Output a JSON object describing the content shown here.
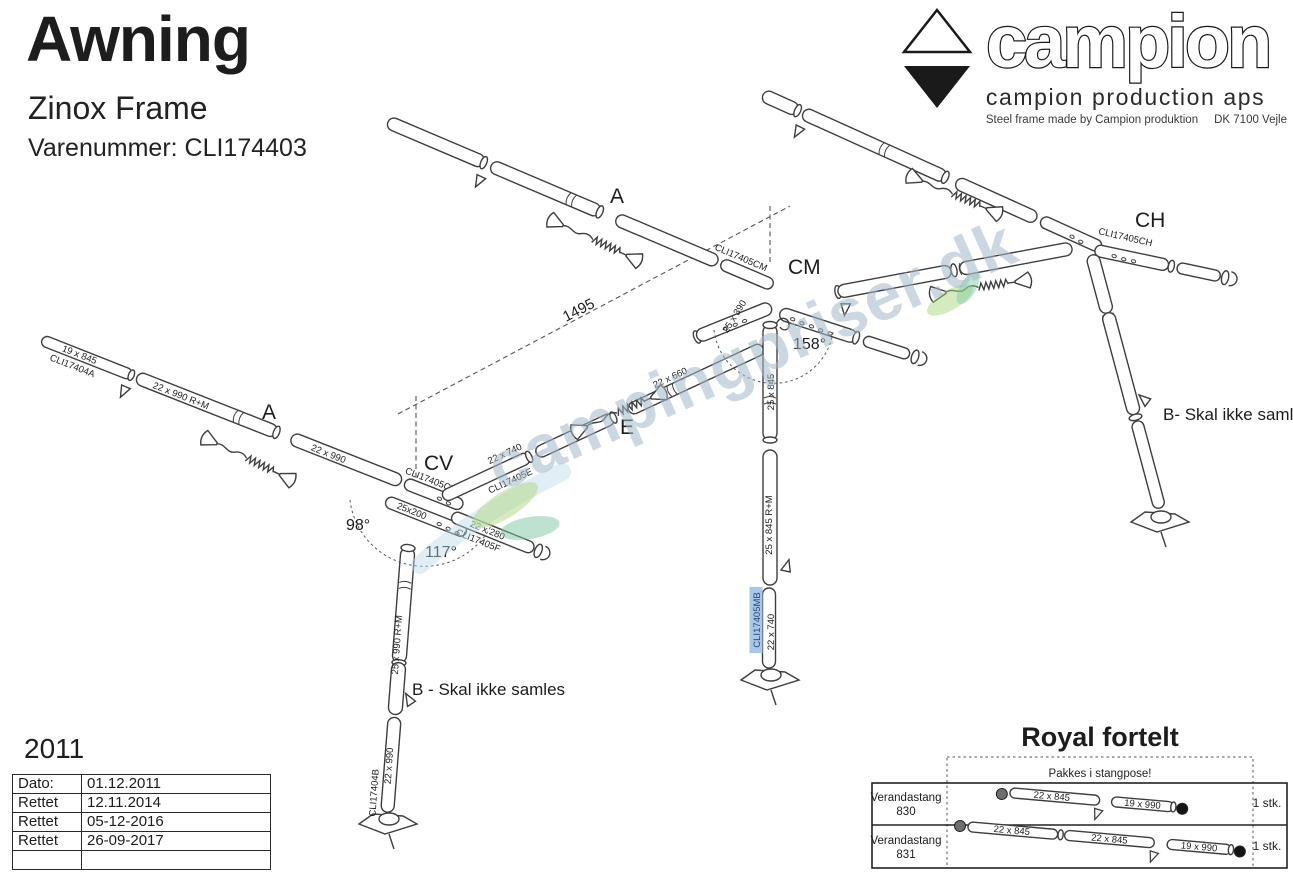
{
  "header": {
    "title": "Awning",
    "subtitle": "Zinox Frame",
    "part_number": "Varenummer: CLI174403"
  },
  "brand": {
    "logo_text": "campion",
    "company": "campion production aps",
    "tagline": "Steel frame made by Campion produktion",
    "location": "DK 7100 Vejle"
  },
  "watermark": {
    "text": "campingpriser.dk"
  },
  "diagram": {
    "markers": {
      "a_top": "A",
      "a_left": "A",
      "cv": "CV",
      "cm": "CM",
      "ch": "CH",
      "e": "E"
    },
    "notes": {
      "b_left": "B - Skal ikke samles",
      "b_right": "B- Skal ikke samles"
    },
    "angles": {
      "cv": "98°",
      "cv2": "117°",
      "cm": "158°"
    },
    "dimension": "1495",
    "parts": {
      "a_tip_size": "19 x 845",
      "a_tip_code": "CLI17404A",
      "a_mid_size": "22 x 990 R+M",
      "a_end_size": "22 x 990",
      "cv_code": "CLI17405CV",
      "cv_size": "25x200",
      "f_size": "22 x 280",
      "f_code": "CLI17405F",
      "e_size": "22 x 740",
      "e_code": "CLI17405E",
      "e_upper_size": "22 x 660",
      "cm_code": "CLI17405CM",
      "cm_stub_size": "25 x 390",
      "mid_upper": "25 x 845",
      "mid_mid": "25 x 845 R+M",
      "mid_code": "CLI17405MB",
      "mid_lower": "22 x 740",
      "left_upper": "25 x 990 R+M",
      "left_lower": "22 x 990",
      "left_code": "CLI17404B",
      "ch_code": "CLI17405CH"
    }
  },
  "revision": {
    "year": "2011",
    "rows": [
      [
        "Dato:",
        "01.12.2011"
      ],
      [
        "Rettet",
        "12.11.2014"
      ],
      [
        "Rettet",
        "05-12-2016"
      ],
      [
        "Rettet",
        "26-09-2017"
      ]
    ]
  },
  "royal": {
    "title": "Royal fortelt",
    "note": "Pakkes i stangpose!",
    "rows": [
      {
        "name": "Verandastang",
        "number": "830",
        "qty": "1 stk.",
        "seg1": "22 x 845",
        "seg2": "19 x 990"
      },
      {
        "name": "Verandastang",
        "number": "831",
        "qty": "1 stk.",
        "seg1": "22 x 845",
        "seg2": "22 x 845",
        "seg3": "19 x 990"
      }
    ]
  }
}
